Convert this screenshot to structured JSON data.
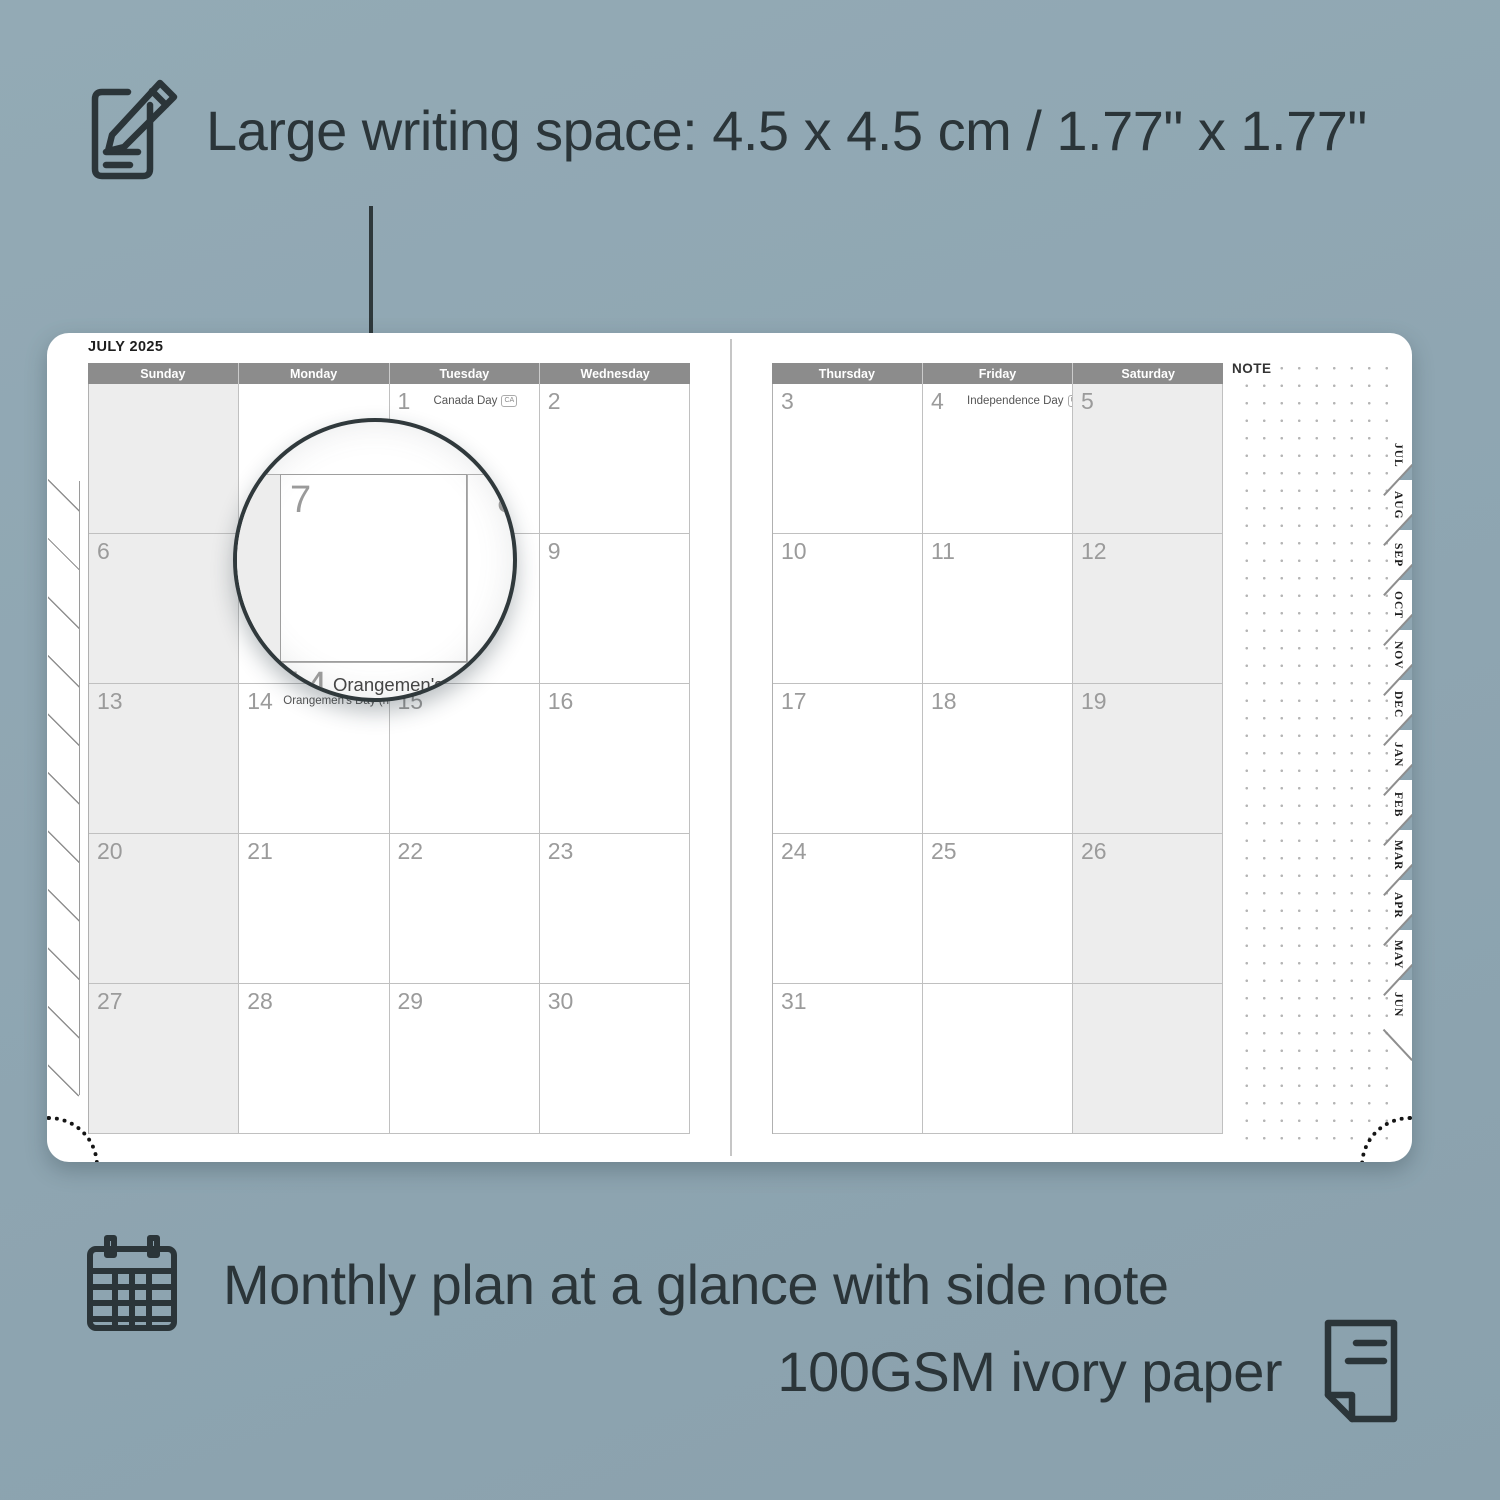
{
  "colors": {
    "background": "#8fa6b2",
    "ink": "#2b3539",
    "header_bar": "#8c8c8c",
    "shaded_cell": "#ededed",
    "grid_line": "#c0c0c0",
    "date_number": "#9b9b9b"
  },
  "top_caption": {
    "icon": "notepad-pencil-icon",
    "label": "Large writing space: 4.5 x 4.5 cm / 1.77\" x 1.77\""
  },
  "planner": {
    "title": "JULY 2025",
    "note_label": "NOTE",
    "left_headers": [
      "Sunday",
      "Monday",
      "Tuesday",
      "Wednesday"
    ],
    "right_headers": [
      "Thursday",
      "Friday",
      "Saturday"
    ],
    "left_rows": [
      [
        {
          "shaded": true
        },
        {},
        {
          "date": "1",
          "holiday": "Canada Day",
          "badge": "CA"
        },
        {
          "date": "2"
        }
      ],
      [
        {
          "date": "6",
          "shaded": true
        },
        {
          "date": "7"
        },
        {
          "date": "8"
        },
        {
          "date": "9"
        }
      ],
      [
        {
          "date": "13",
          "shaded": true
        },
        {
          "date": "14",
          "holiday": "Orangemen's Day (n.i.)",
          "badge": "UK"
        },
        {
          "date": "15"
        },
        {
          "date": "16"
        }
      ],
      [
        {
          "date": "20",
          "shaded": true
        },
        {
          "date": "21"
        },
        {
          "date": "22"
        },
        {
          "date": "23"
        }
      ],
      [
        {
          "date": "27",
          "shaded": true
        },
        {
          "date": "28"
        },
        {
          "date": "29"
        },
        {
          "date": "30"
        }
      ]
    ],
    "right_rows": [
      [
        {
          "date": "3"
        },
        {
          "date": "4",
          "holiday": "Independence Day",
          "badge": "US"
        },
        {
          "date": "5",
          "shaded": true
        }
      ],
      [
        {
          "date": "10"
        },
        {
          "date": "11"
        },
        {
          "date": "12",
          "shaded": true
        }
      ],
      [
        {
          "date": "17"
        },
        {
          "date": "18"
        },
        {
          "date": "19",
          "shaded": true
        }
      ],
      [
        {
          "date": "24"
        },
        {
          "date": "25"
        },
        {
          "date": "26",
          "shaded": true
        }
      ],
      [
        {
          "date": "31"
        },
        {},
        {
          "shaded": true
        }
      ]
    ],
    "month_tabs": [
      "JUL",
      "AUG",
      "SEP",
      "OCT",
      "NOV",
      "DEC",
      "JAN",
      "FEB",
      "MAR",
      "APR",
      "MAY",
      "JUN"
    ],
    "magnifier": {
      "left_date": "7",
      "right_date": "8",
      "footer_date": "14",
      "footer_holiday": "Orangemen's Day (n.i.)",
      "footer_badge": "UK"
    }
  },
  "bottom_captions": {
    "first": {
      "icon": "calendar-grid-icon",
      "label": "Monthly plan at a glance with side note"
    },
    "second": {
      "icon": "paper-sheet-icon",
      "label": "100GSM ivory paper"
    }
  }
}
